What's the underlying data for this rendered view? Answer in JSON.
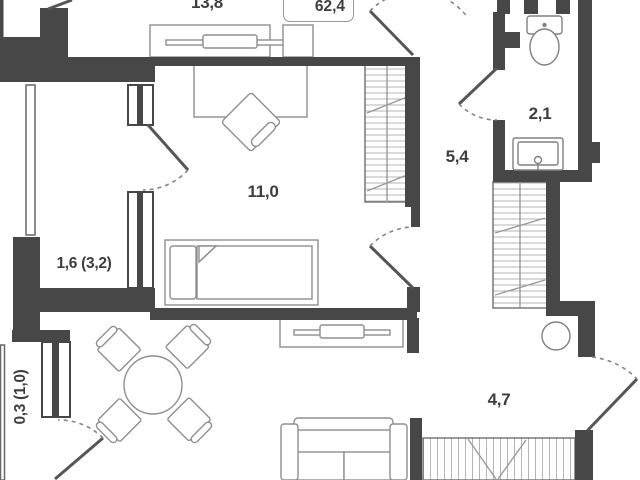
{
  "floorplan": {
    "total_area": "62,4",
    "rooms": {
      "kitchen_living": "13,8",
      "bedroom": "11,0",
      "loggia_upper": "1,6 (3,2)",
      "loggia_lower": "0,3 (1,0)",
      "hallway": "5,4",
      "bathroom": "2,1",
      "corridor": "4,7"
    },
    "colors": {
      "wall": "#474747",
      "furniture_line": "#8f8f8f",
      "text": "#3e3e3e"
    }
  }
}
